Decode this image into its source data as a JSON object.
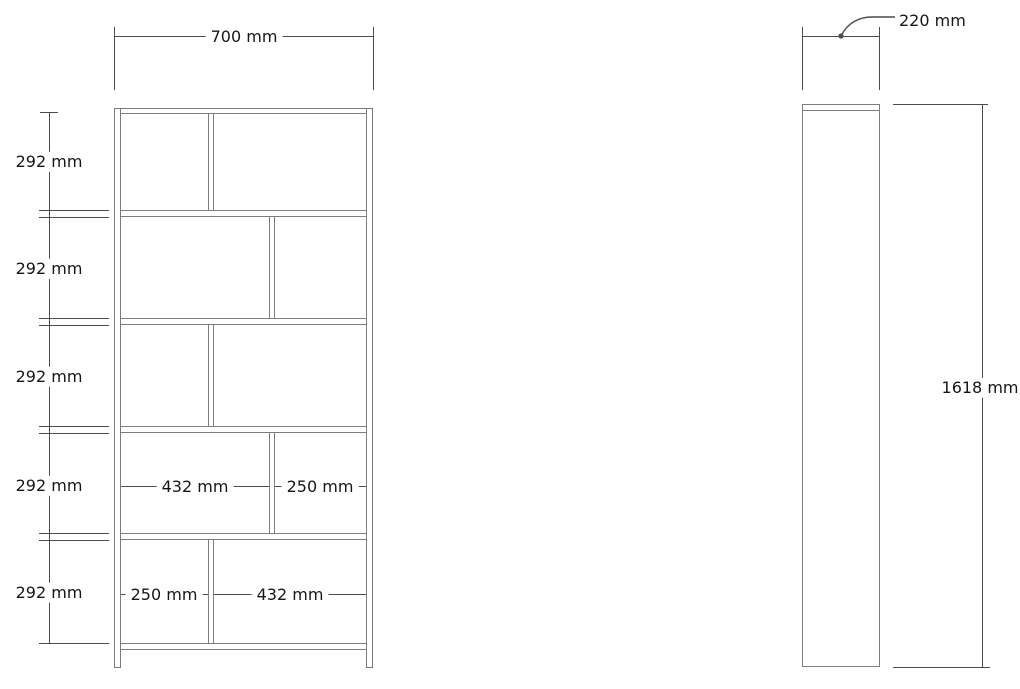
{
  "drawing_title": "bookcase-dimension-drawing",
  "front_view": {
    "overall_width": "700 mm",
    "row_heights": [
      "292 mm",
      "292 mm",
      "292 mm",
      "292 mm",
      "292 mm"
    ],
    "row4_compartments": {
      "left": "432 mm",
      "right": "250 mm"
    },
    "row5_compartments": {
      "left": "250 mm",
      "right": "432 mm"
    }
  },
  "side_view": {
    "depth": "220 mm",
    "overall_height": "1618 mm"
  },
  "colors": {
    "line": "#7d7d7d",
    "dim": "#4c4c4c",
    "text": "#161616",
    "bg": "#ffffff"
  }
}
